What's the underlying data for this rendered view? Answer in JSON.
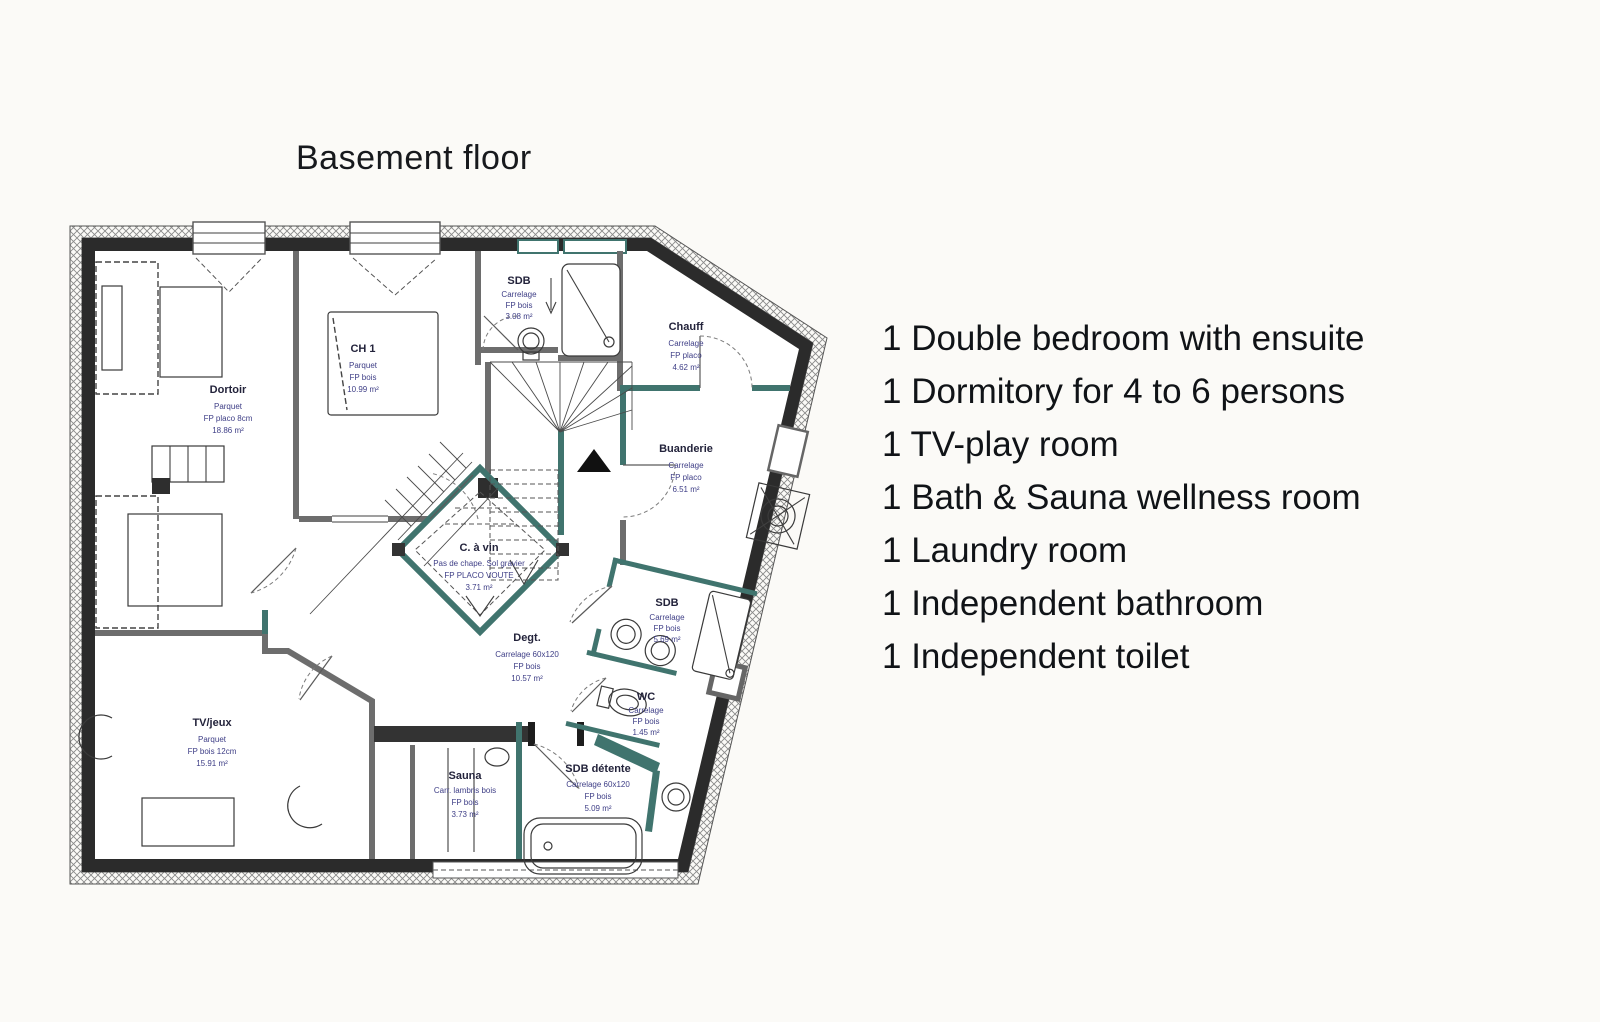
{
  "title": "Basement floor",
  "features": [
    "1 Double bedroom with ensuite",
    "1 Dormitory for 4 to 6 persons",
    "1 TV-play room",
    "1 Bath & Sauna wellness room",
    "1 Laundry room",
    "1 Independent bathroom",
    "1 Independent toilet"
  ],
  "plan": {
    "colors": {
      "exterior_wall": "#2b2b2b",
      "partition_wall": "#6d6d6d",
      "new_partition_wall": "#40746e",
      "label_name": "#23233b",
      "label_sub": "#3e3e86"
    },
    "rooms": [
      {
        "id": "dortoir",
        "name": "Dortoir",
        "l1": "Parquet",
        "l2": "FP placo 8cm",
        "l3": "18.86 m²"
      },
      {
        "id": "ch1",
        "name": "CH 1",
        "l1": "Parquet",
        "l2": "FP bois",
        "l3": "10.99 m²"
      },
      {
        "id": "sdb-top",
        "name": "SDB",
        "l1": "Carrelage",
        "l2": "FP bois",
        "l3": "3.08 m²"
      },
      {
        "id": "chauff",
        "name": "Chauff",
        "l1": "Carrelage",
        "l2": "FP placo",
        "l3": "4.62 m²"
      },
      {
        "id": "buanderie",
        "name": "Buanderie",
        "l1": "Carrelage",
        "l2": "FP placo",
        "l3": "6.51 m²"
      },
      {
        "id": "cave-a-vin",
        "name": "C. à vin",
        "l1": "Pas de chape. Sol gravier",
        "l2": "FP PLACO VOUTE",
        "l3": "3.71 m²"
      },
      {
        "id": "degagement",
        "name": "Degt.",
        "l1": "Carrelage 60x120",
        "l2": "FP bois",
        "l3": "10.57 m²"
      },
      {
        "id": "sdb-mid",
        "name": "SDB",
        "l1": "Carrelage",
        "l2": "FP bois",
        "l3": "5.69 m²"
      },
      {
        "id": "wc",
        "name": "WC",
        "l1": "Carrelage",
        "l2": "FP bois",
        "l3": "1.45 m²"
      },
      {
        "id": "tv-jeux",
        "name": "TV/jeux",
        "l1": "Parquet",
        "l2": "FP bois 12cm",
        "l3": "15.91 m²"
      },
      {
        "id": "sauna",
        "name": "Sauna",
        "l1": "Carr. lambris bois",
        "l2": "FP bois",
        "l3": "3.73 m²"
      },
      {
        "id": "sdb-detente",
        "name": "SDB détente",
        "l1": "Carrelage 60x120",
        "l2": "FP bois",
        "l3": "5.09 m²"
      }
    ]
  }
}
